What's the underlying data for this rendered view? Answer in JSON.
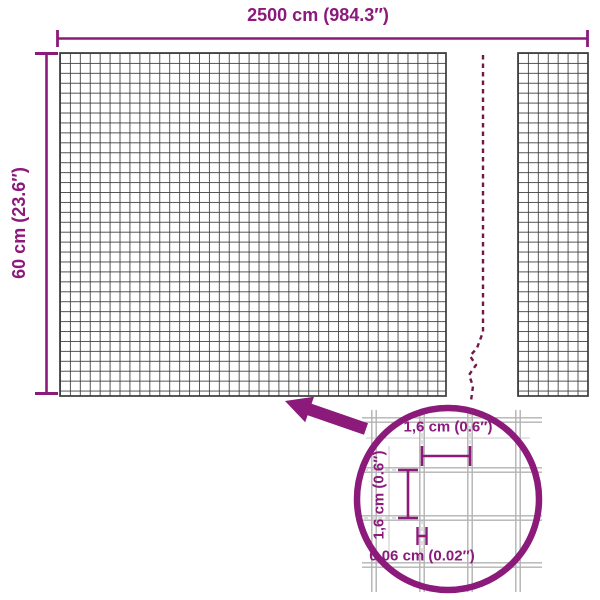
{
  "diagram": {
    "product": "welded-wire-mesh-roll-dimensions",
    "overall": {
      "width_label": "2500 cm (984.3″)",
      "height_label": "60 cm (23.6″)"
    },
    "detail": {
      "opening_width_label": "1,6 cm (0.6″)",
      "opening_height_label": "1,6 cm (0.6″)",
      "wire_thickness_label": "0,06 cm (0.02″)"
    },
    "colors": {
      "accent": "#8B1A7B",
      "break_line": "#701945",
      "mesh_line": "#3B3B3B",
      "detail_wire": "#B3B3B3",
      "helper_line": "#C8C8C8",
      "background": "#FFFFFF"
    }
  }
}
